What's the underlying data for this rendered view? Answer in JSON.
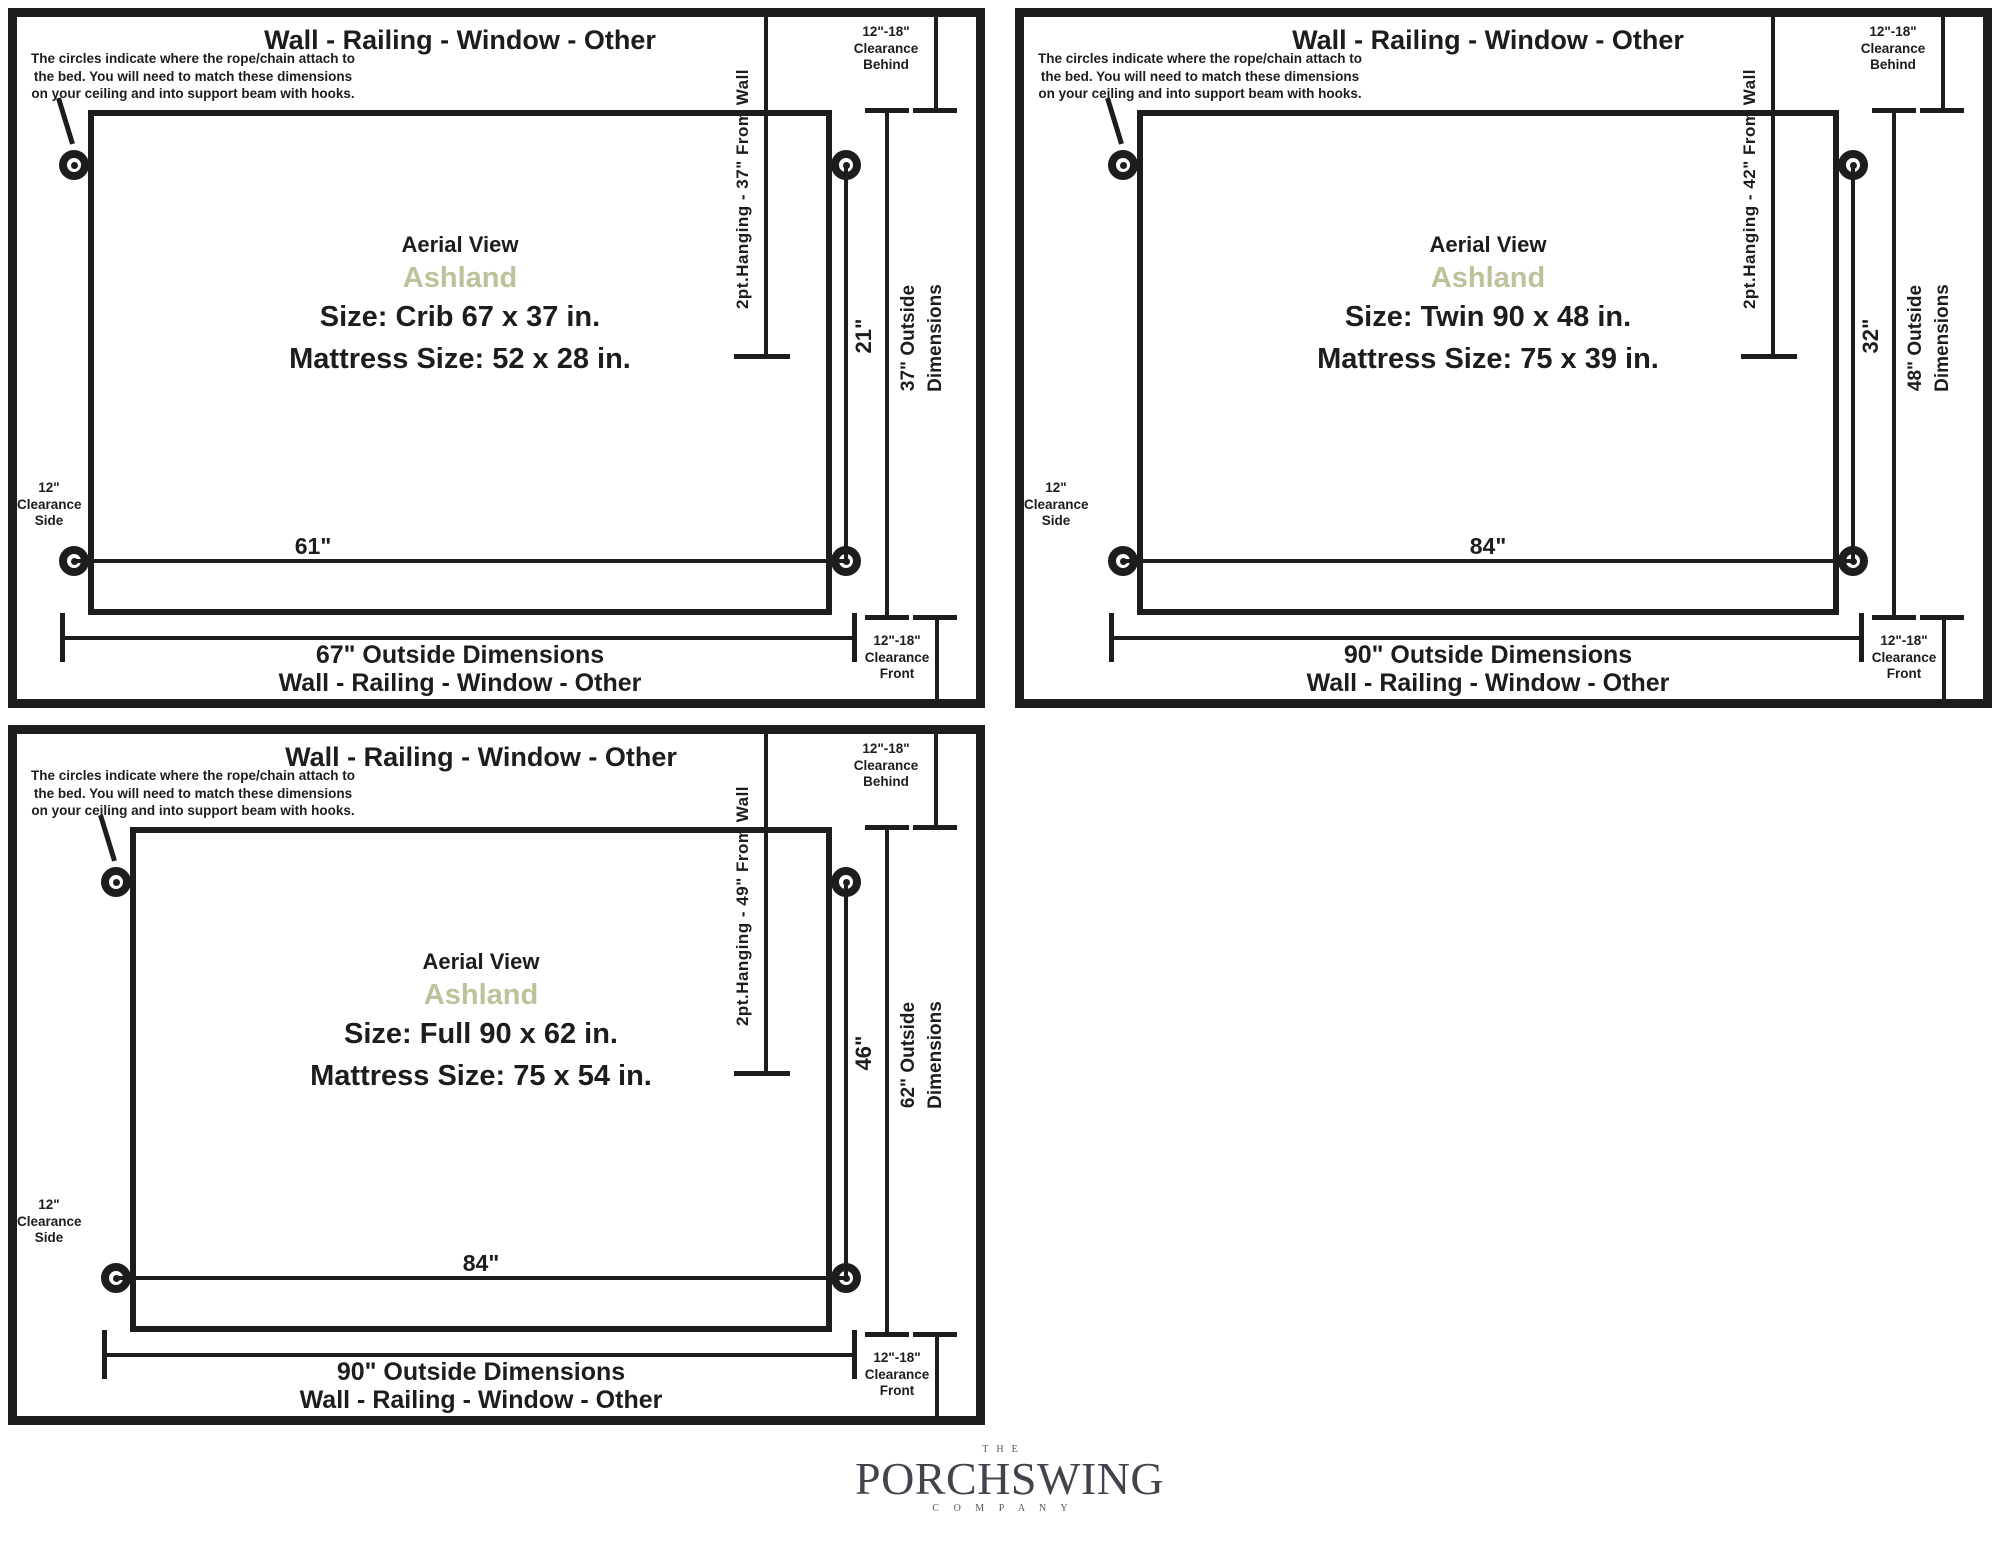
{
  "colors": {
    "ink": "#1d1d1d",
    "model_sage": "#bfc19b",
    "logo_dark": "#43434d",
    "logo_small": "#55555f"
  },
  "panels": [
    {
      "wall_label_top": "Wall - Railing - Window - Other",
      "note": "The circles indicate where the rope/chain attach to\nthe bed. You will need to match these dimensions\non your ceiling and into support beam with hooks.",
      "aerial": "Aerial View",
      "model": "Ashland",
      "size": "Size: Crib 67 x 37 in.",
      "mattress": "Mattress Size: 52 x 28 in.",
      "hanging": "2pt.Hanging - 37\" From Wall",
      "span": "61\"",
      "depth": "21\"",
      "outside_dim_line1": "37\" Outside",
      "outside_dim_line2": "Dimensions",
      "outside_width": "67\" Outside Dimensions",
      "wall_label_bottom": "Wall - Railing - Window - Other",
      "clearance_behind": "12\"-18\"\nClearance\nBehind",
      "clearance_front": "12\"-18\"\nClearance\nFront",
      "clearance_side": "12\"\nClearance\nSide"
    },
    {
      "wall_label_top": "Wall - Railing - Window - Other",
      "note": "The circles indicate where the rope/chain attach to\nthe bed. You will need to match these dimensions\non your ceiling and into support beam with hooks.",
      "aerial": "Aerial View",
      "model": "Ashland",
      "size": "Size: Twin 90 x 48 in.",
      "mattress": "Mattress Size: 75 x 39 in.",
      "hanging": "2pt.Hanging - 42\" From Wall",
      "span": "84\"",
      "depth": "32\"",
      "outside_dim_line1": "48\" Outside",
      "outside_dim_line2": "Dimensions",
      "outside_width": "90\" Outside Dimensions",
      "wall_label_bottom": "Wall - Railing - Window - Other",
      "clearance_behind": "12\"-18\"\nClearance\nBehind",
      "clearance_front": "12\"-18\"\nClearance\nFront",
      "clearance_side": "12\"\nClearance\nSide"
    },
    {
      "wall_label_top": "Wall - Railing - Window - Other",
      "note": "The circles indicate where the rope/chain attach to\nthe bed. You will need to match these dimensions\non your ceiling and into support beam with hooks.",
      "aerial": "Aerial View",
      "model": "Ashland",
      "size": "Size: Full 90 x 62 in.",
      "mattress": "Mattress Size: 75 x 54 in.",
      "hanging": "2pt.Hanging - 49\" From Wall",
      "span": "84\"",
      "depth": "46\"",
      "outside_dim_line1": "62\" Outside",
      "outside_dim_line2": "Dimensions",
      "outside_width": "90\" Outside Dimensions",
      "wall_label_bottom": "Wall - Railing - Window - Other",
      "clearance_behind": "12\"-18\"\nClearance\nBehind",
      "clearance_front": "12\"-18\"\nClearance\nFront",
      "clearance_side": "12\"\nClearance\nSide"
    }
  ],
  "logo": {
    "the": "THE",
    "name": "PORCHSWING",
    "company": "C O M P A N Y"
  }
}
